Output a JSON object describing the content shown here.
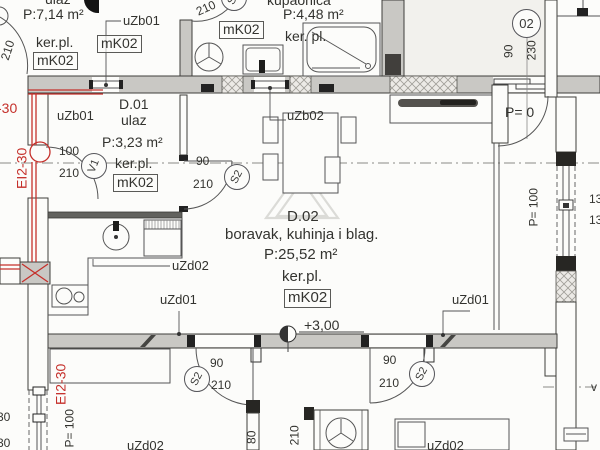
{
  "meta": {
    "type": "architectural floor plan",
    "language": "hr"
  },
  "palette": {
    "fire_red": "#c5302b",
    "wall_fill": "#c9c8c4",
    "line": "#3e3e3b",
    "watermark": "#dbdbd7",
    "paper": "#fcfcfa"
  },
  "rooms": {
    "upper_ulaz": {
      "name": "ulaz",
      "area": "P:7,14 m²",
      "floor": "ker.pl.",
      "floor_mark": "mK02",
      "floor_mark_b": "mK02"
    },
    "kupaonica": {
      "name": "kupaonica",
      "area": "P:4,48 m²",
      "floor": "ker. pl.",
      "floor_mark": "mK02"
    },
    "d01": {
      "id": "D.01",
      "name": "ulaz",
      "area": "P:3,23 m²",
      "floor": "ker.pl.",
      "floor_mark": "mK02"
    },
    "d02": {
      "id": "D.02",
      "name": "boravak, kuhinja i blag.",
      "area": "P:25,52 m²",
      "floor": "ker.pl.",
      "floor_mark": "mK02",
      "elevation": "+3,00"
    }
  },
  "unit_badge": {
    "number": "02",
    "door_width": "90",
    "door_height": "230"
  },
  "openings": {
    "uzb01_top": "uZb01",
    "uzb01_entry": "uZb01",
    "uzb02": "uZb02",
    "uzd01_left": "uZd01",
    "uzd01_right": "uZd01",
    "uzd02_kitchen": "uZd02",
    "uzd02_bottom_left": "uZd02",
    "uzd02_bottom_right": "uZd02"
  },
  "doors": {
    "top_left": {
      "height": "210"
    },
    "bath": {
      "tag": "S2",
      "height": "210"
    },
    "entry": {
      "tag": "V1",
      "width": "100",
      "height": "210"
    },
    "living": {
      "tag": "S2",
      "width": "90",
      "height": "210"
    },
    "bottom_left": {
      "tag": "S2",
      "width": "90",
      "height": "210"
    },
    "bottom_right": {
      "tag": "S2",
      "width": "90",
      "height": "210"
    }
  },
  "fire_rating": {
    "upper": "EI2-30",
    "lower": "EI2-30",
    "cut": "-30"
  },
  "parapets": {
    "terrace": "P= 0",
    "right": "P= 100",
    "left": "P= 100"
  },
  "shaft": {
    "width": "80",
    "depth": "210"
  },
  "edge_cuts": {
    "left_a": "30",
    "left_b": "30",
    "right_a": "13",
    "right_b": "13",
    "v": "v"
  }
}
